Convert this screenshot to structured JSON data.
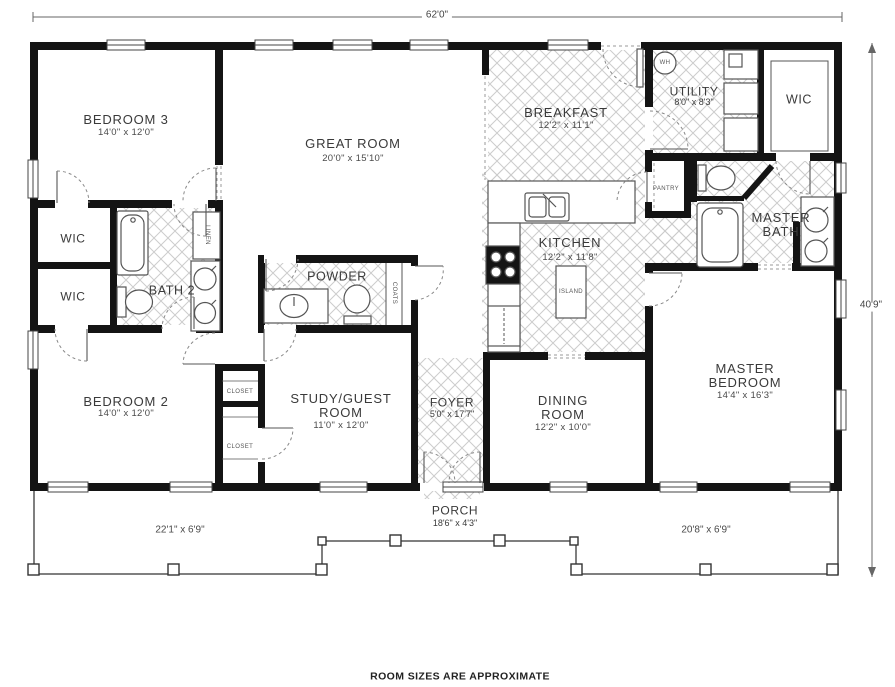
{
  "footer_note": "ROOM SIZES ARE APPROXIMATE",
  "dimensions": {
    "overall_width": "62'0\"",
    "overall_height": "40'9\""
  },
  "rooms": {
    "bedroom3": {
      "name": "BEDROOM 3",
      "size": "14'0\" x 12'0\""
    },
    "great_room": {
      "name": "GREAT ROOM",
      "size": "20'0\" x 15'10\""
    },
    "breakfast": {
      "name": "BREAKFAST",
      "size": "12'2\" x 11'1\""
    },
    "utility": {
      "name": "UTILITY",
      "size": "8'0\" x 8'3\""
    },
    "wic_master": {
      "name": "WIC"
    },
    "wic_b3": {
      "name": "WIC"
    },
    "wic_b2": {
      "name": "WIC"
    },
    "bath2": {
      "name": "BATH 2"
    },
    "powder": {
      "name": "POWDER"
    },
    "kitchen": {
      "name": "KITCHEN",
      "size": "12'2\" x 11'8\""
    },
    "master_bath": {
      "name": "MASTER BATH"
    },
    "bedroom2": {
      "name": "BEDROOM 2",
      "size": "14'0\" x 12'0\""
    },
    "study": {
      "name": "STUDY/GUEST ROOM",
      "size": "11'0\" x 12'0\""
    },
    "foyer": {
      "name": "FOYER",
      "size": "5'0\" x 17'7\""
    },
    "dining": {
      "name": "DINING ROOM",
      "size": "12'2\" x 10'0\""
    },
    "master_bedroom": {
      "name": "MASTER BEDROOM",
      "size": "14'4\" x 16'3\""
    },
    "porch": {
      "name": "PORCH",
      "size": "18'6\" x 4'3\""
    }
  },
  "closets": {
    "closet_upper": "CLOSET",
    "closet_lower": "CLOSET",
    "pantry": "PANTRY",
    "linen": "LINEN",
    "coats": "COATS",
    "island": "ISLAND",
    "water_heater": "WH"
  },
  "porch_dims": {
    "left": "22'1\" x 6'9\"",
    "right": "20'8\" x 6'9\""
  },
  "colors": {
    "wall": "#141414",
    "line": "#555555",
    "hatch": "#cccccc",
    "text": "#3a3a3a"
  }
}
